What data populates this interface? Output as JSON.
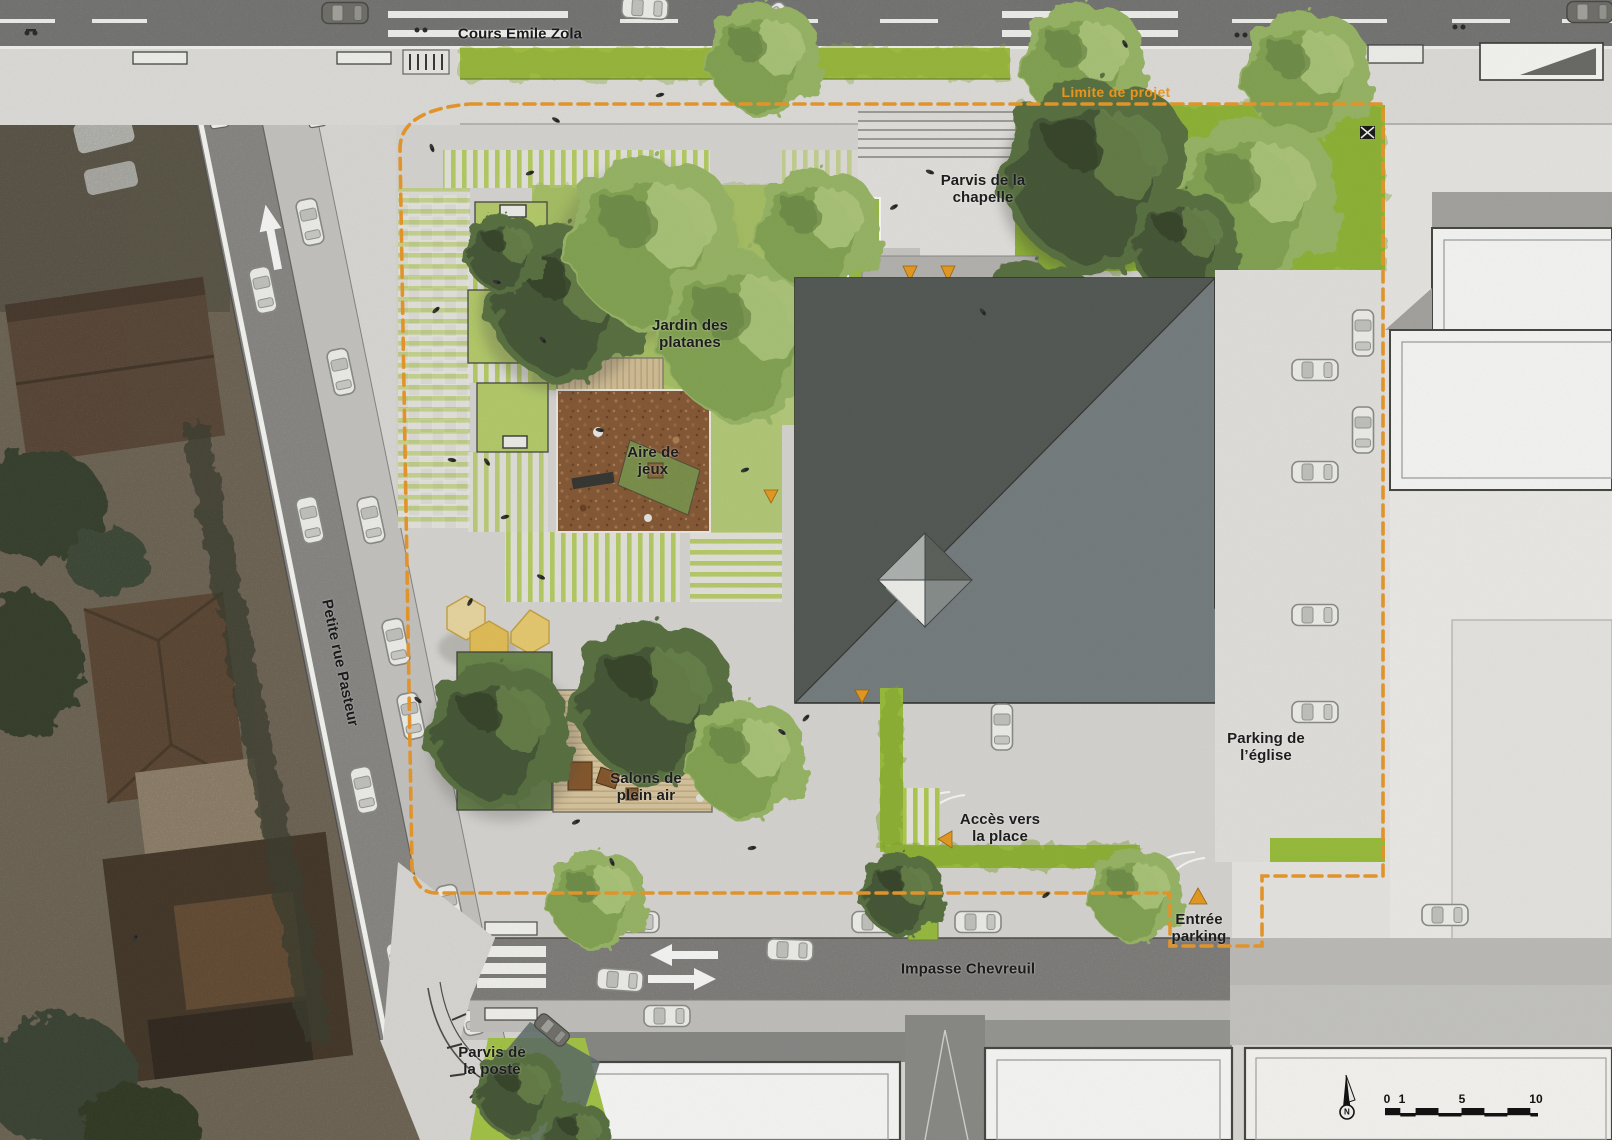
{
  "plan": {
    "title": "Place publique – plan d'aménagement",
    "streets": {
      "cours_emile_zola": "Cours Emile Zola",
      "petite_rue_pasteur": "Petite rue Pasteur",
      "impasse_chevreuil": "Impasse Chevreuil"
    },
    "areas": {
      "parvis_chapelle": "Parvis de la\nchapelle",
      "jardin_platanes": "Jardin des\nplatanes",
      "aire_jeux": "Aire de\njeux",
      "salons_plein_air": "Salons de\nplein air",
      "parking_eglise": "Parking de\nl’église",
      "acces_place": "Accès vers\nla place",
      "entree_parking": "Entrée\nparking",
      "parvis_poste": "Parvis de\nla poste"
    },
    "boundary_label": "Limite de projet",
    "scale_bar": {
      "ticks": [
        "0",
        "1",
        "5",
        "10"
      ],
      "north": "N"
    },
    "colors": {
      "boundary_orange": "#ee9c2e",
      "road_gray": "#8e8e8c",
      "plaza_gray": "#dcdbd7",
      "grass_green": "#a6c344",
      "church_dark": "#575d58",
      "church_light": "#7a8284",
      "mulch_brown": "#8a5d3a",
      "deck_tan": "#dcc9a2",
      "kiosk_yellow": "#ecd27c"
    }
  }
}
